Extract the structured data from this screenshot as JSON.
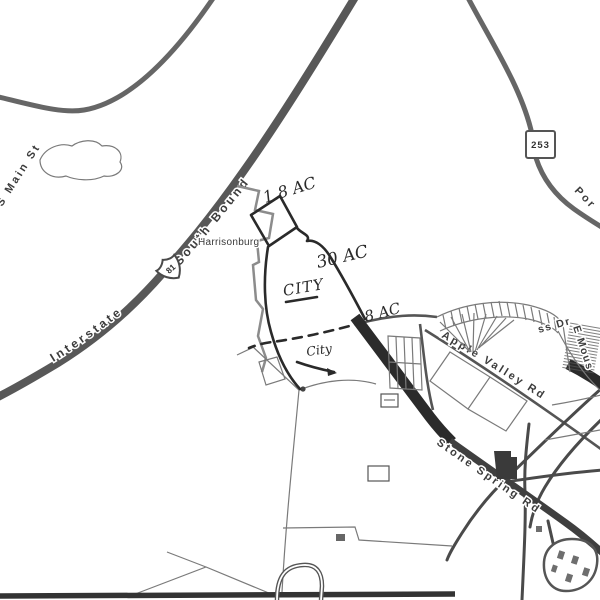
{
  "map": {
    "roads": {
      "s_main_st": {
        "label": "S Main St"
      },
      "interstate_81": {
        "label_part1": "Interstate",
        "shield": "81",
        "label_part2": "South Bound"
      },
      "route_253": {
        "shield": "253",
        "label_partial": "Por"
      },
      "apple_valley_rd": {
        "label": "Apple Valley Rd"
      },
      "stone_spring_rd": {
        "label": "Stone Spring Rd"
      },
      "ss_dr": {
        "label": "ss Dr"
      },
      "e_mous": {
        "label": "E Mous"
      }
    },
    "places": {
      "city": "Harrisonburg"
    },
    "annotations": {
      "parcel_area_1": "1.8 AC",
      "parcel_area_2": "30 AC",
      "parcel_area_3": "8 AC",
      "jurisdiction_note_upper": "CITY",
      "jurisdiction_note_lower": "City"
    },
    "colors": {
      "background": "#ffffff",
      "road_major": "#585858",
      "road_network": "#4a4a4a",
      "highlight_band": "#2b2b2b",
      "city_boundary": "#8c8c8c",
      "parcel_line": "#7a7a7a",
      "annotation_ink": "#2a2a2a",
      "label_text": "#3c3c3c"
    }
  }
}
